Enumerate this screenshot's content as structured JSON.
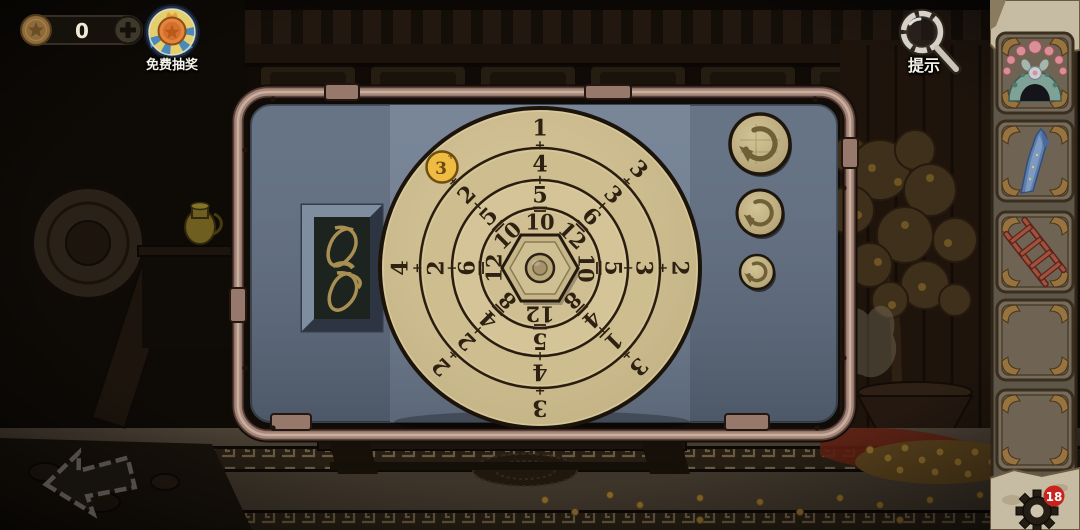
{
  "hud": {
    "coin_counter": {
      "value": "0",
      "coin_icon": "star-coin-icon",
      "plus_label": "+"
    },
    "free_lottery": {
      "label": "免费抽奖",
      "icon": "medal-star-badge-icon"
    },
    "hint": {
      "label": "提示",
      "icon": "magnifier-icon"
    },
    "settings_gear": {
      "icon": "gear-icon",
      "badge_count": "18"
    }
  },
  "inventory": {
    "items": [
      {
        "slot": 1,
        "name": "opera-headdress",
        "empty": false
      },
      {
        "slot": 2,
        "name": "blue-silk-sleeve",
        "empty": false
      },
      {
        "slot": 3,
        "name": "wooden-ladder",
        "empty": false
      },
      {
        "slot": 4,
        "name": "",
        "empty": true
      },
      {
        "slot": 5,
        "name": "",
        "empty": true
      }
    ]
  },
  "puzzle_panel": {
    "token": {
      "value": "3",
      "suffix": "+",
      "color": "#eebc42"
    },
    "rope_item": {
      "name": "coiled-rope"
    },
    "rotate_buttons": [
      {
        "name": "rotate-outer-ring-button",
        "size": "large"
      },
      {
        "name": "rotate-middle-ring-button",
        "size": "medium"
      },
      {
        "name": "rotate-inner-ring-button",
        "size": "small"
      }
    ],
    "dial": {
      "type": "concentric-number-rings",
      "rings_from_outer_to_center": 4,
      "separator": "+",
      "radials": [
        {
          "direction": "N",
          "angle": 0,
          "outer": "1",
          "middle": "4",
          "inner": "5",
          "center": "10",
          "inner_underlined": true
        },
        {
          "direction": "NE",
          "angle": 45,
          "outer": "3",
          "middle": "3",
          "inner": "6",
          "center": "12",
          "inner_underlined": true
        },
        {
          "direction": "E",
          "angle": 90,
          "outer": "2",
          "middle": "3",
          "inner": "5",
          "center": "10",
          "inner_underlined": true
        },
        {
          "direction": "SE",
          "angle": 135,
          "outer": "3",
          "middle": "1",
          "inner": "4",
          "center": "8",
          "inner_underlined": true,
          "middle_underlined": true
        },
        {
          "direction": "S",
          "angle": 180,
          "outer": "3",
          "middle": "4",
          "inner": "5",
          "center": "12",
          "inner_underlined": true
        },
        {
          "direction": "SW",
          "angle": 225,
          "outer": "2",
          "middle": "2",
          "inner": "4",
          "center": "8",
          "inner_underlined": true
        },
        {
          "direction": "W",
          "angle": 270,
          "outer": "4",
          "middle": "2",
          "inner": "6",
          "center": "12",
          "inner_underlined": true
        },
        {
          "direction": "NW",
          "angle": 315,
          "outer": "3",
          "middle": "2",
          "inner": "5",
          "center": "10",
          "inner_underlined": true,
          "outer_covered_by_token": true
        }
      ]
    }
  },
  "colors": {
    "panel_blue_mid": "#6f7e92",
    "panel_blue_side": "#5d6b7e",
    "dial_gold": "#cdbc8e",
    "dial_line": "#241a0e",
    "frame_metal": "#a5887b",
    "token_yellow": "#eebc42",
    "badge_red": "#c8231d",
    "parchment": "#c6bca4"
  }
}
